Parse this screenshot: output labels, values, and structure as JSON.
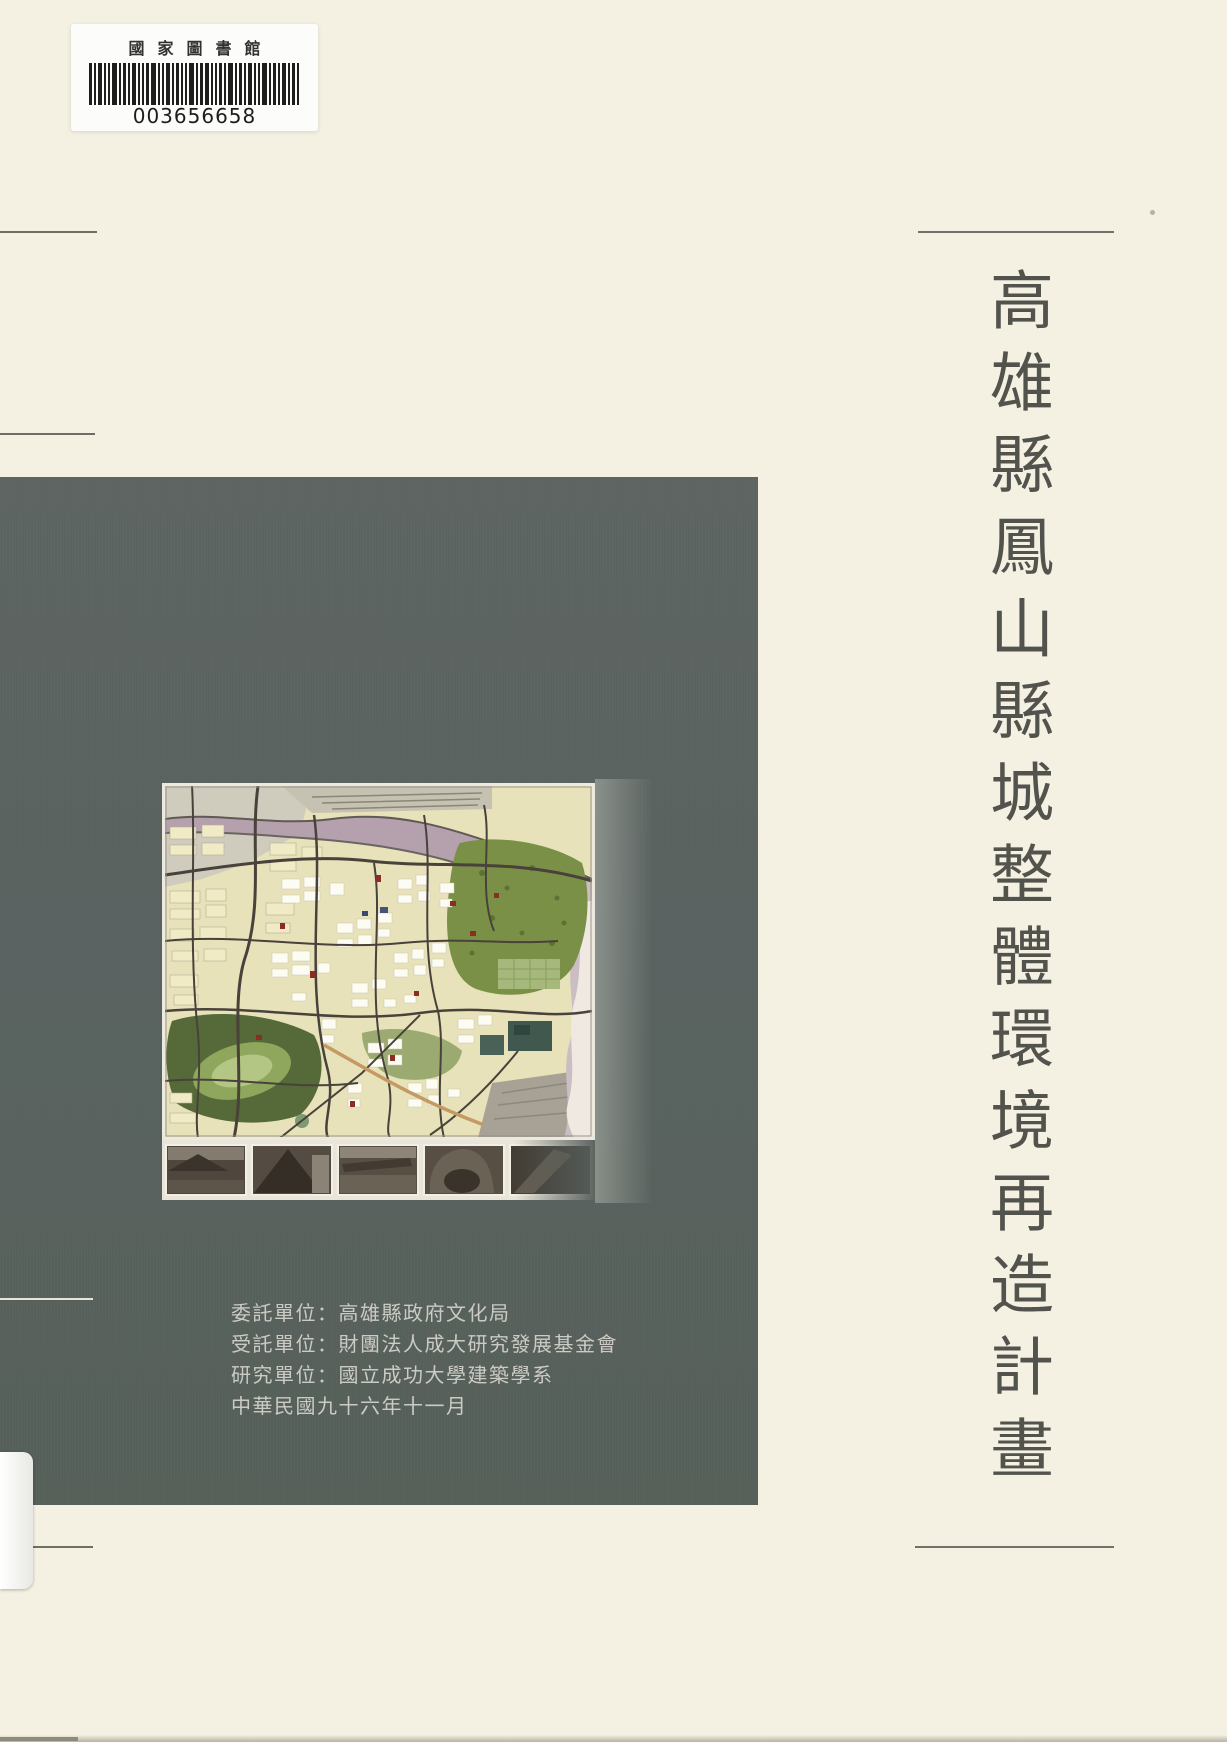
{
  "colors": {
    "background": "#f4f1e3",
    "panel": "#5b625f",
    "title_text": "#53534d",
    "credits_text": "#cbcbc4"
  },
  "library_label": {
    "institution": "國家圖書館",
    "barcode_number": "003656658"
  },
  "title": {
    "text": "高雄縣鳳山縣城整體環境再造計畫"
  },
  "credits": {
    "lines": [
      "委託單位：高雄縣政府文化局",
      "受託單位：財團法人成大研究發展基金會",
      "研究單位：國立成功大學建築學系",
      "中華民國九十六年十一月"
    ]
  },
  "cover_image": {
    "type": "urban-plan-map-with-photo-strip",
    "photo_count": 5
  }
}
